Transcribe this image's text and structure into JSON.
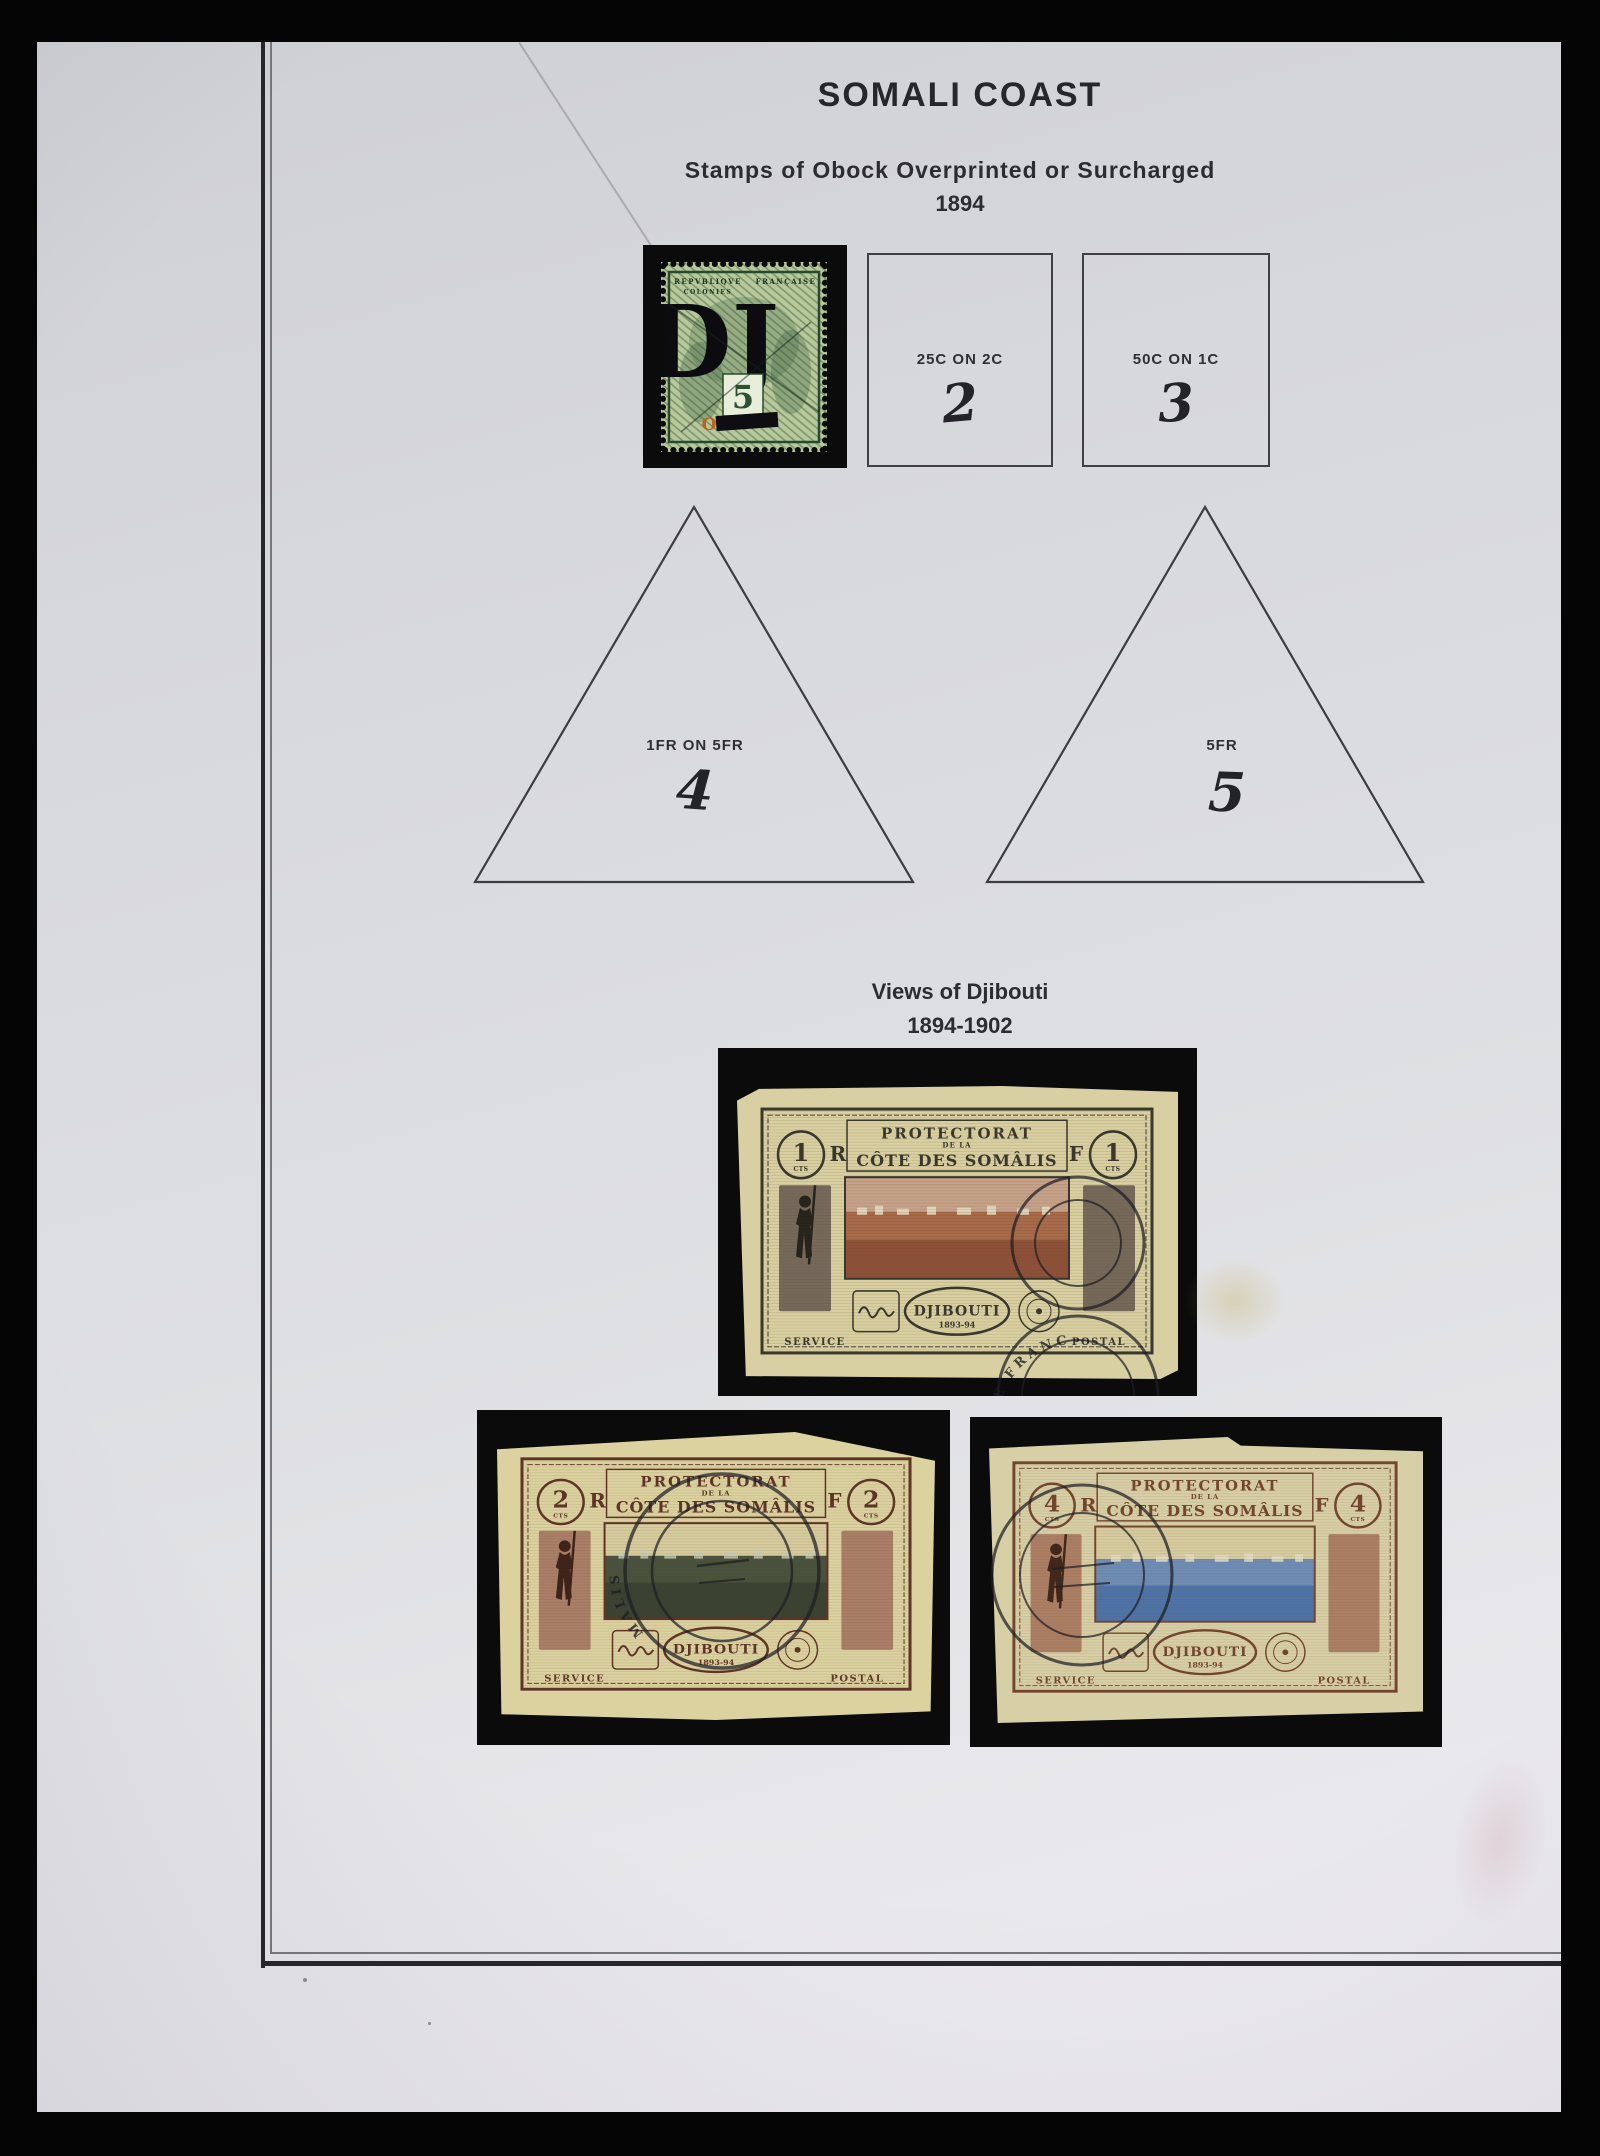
{
  "header": {
    "title": "SOMALI COAST",
    "subtitle": "Stamps of Obock Overprinted or Surcharged",
    "year": "1894"
  },
  "obock": {
    "box25": {
      "label": "25C ON 2C",
      "number": "2"
    },
    "box50": {
      "label": "50C ON 1C",
      "number": "3"
    },
    "tri1fr": {
      "label": "1FR ON 5FR",
      "number": "4"
    },
    "tri5fr": {
      "label": "5FR",
      "number": "5"
    },
    "dj_stamp": {
      "inscription_left": "REPVBLIQVE",
      "inscription_right": "FRANÇAISE",
      "inscription_colonies": "COLONIES",
      "overprint": "DJ",
      "value": "5",
      "obock_letter": "O",
      "colors": {
        "paper": "#b7c89a",
        "ink": "#2a4a30",
        "overprint": "#0c0c10",
        "orange": "#c06018"
      }
    }
  },
  "views": {
    "title": "Views of Djibouti",
    "years": "1894-1902",
    "stamps": [
      {
        "value": "1",
        "unit": "CTS",
        "letter_left": "R",
        "letter_right": "F",
        "banner1": "PROTECTORAT",
        "banner2": "DE LA",
        "banner3": "CÔTE DES SOMÂLIS",
        "name": "DJIBOUTI",
        "name_years": "1893-94",
        "bottom_left": "SERVICE",
        "bottom_right": "POSTAL",
        "postmark_text": "TE FRANC",
        "colors": {
          "frame": "#3a372c",
          "paper": "#d9cfa0",
          "sky": "#c6a288",
          "town": "#8e5138"
        }
      },
      {
        "value": "2",
        "unit": "CTS",
        "letter_left": "R",
        "letter_right": "F",
        "banner1": "PROTECTORAT",
        "banner2": "DE LA",
        "banner3": "CÔTE DES SOMÂLIS",
        "name": "DJIBOUTI",
        "name_years": "1893-94",
        "bottom_left": "SERVICE",
        "bottom_right": "POSTAL",
        "postmark_text": "ES SOMALIS",
        "colors": {
          "frame": "#5e3426",
          "paper": "#dbd2a0",
          "sky": "#d6cc9e",
          "town": "#3a4232"
        }
      },
      {
        "value": "4",
        "unit": "CTS",
        "letter_left": "R",
        "letter_right": "F",
        "banner1": "PROTECTORAT",
        "banner2": "DE LA",
        "banner3": "CÔTE DES SOMÂLIS",
        "name": "DJIBOUTI",
        "name_years": "1893-94",
        "bottom_left": "SERVICE",
        "bottom_right": "POSTAL",
        "postmark_text": "",
        "colors": {
          "frame": "#73452e",
          "paper": "#d7cfa6",
          "sky": "#d6cc9f",
          "town": "#4d73a7"
        }
      }
    ]
  }
}
